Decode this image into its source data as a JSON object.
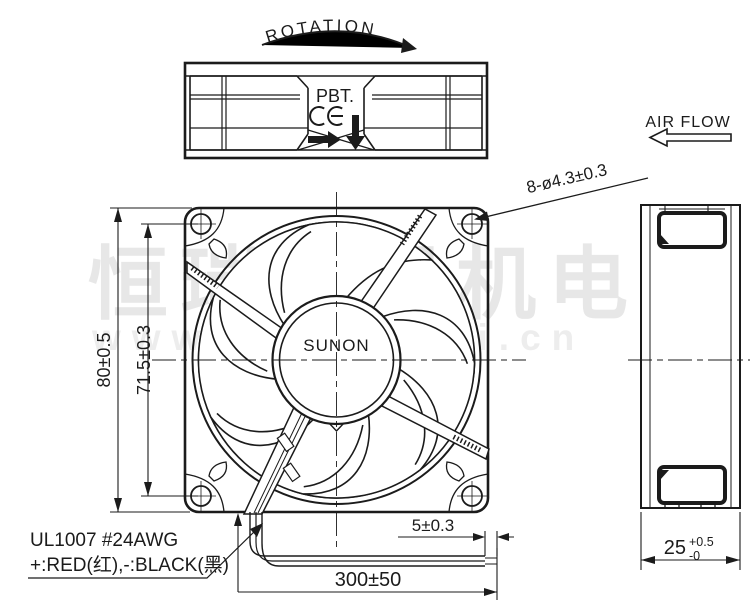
{
  "labels": {
    "rotation": "ROTATION",
    "air_flow": "AIR FLOW",
    "material": "PBT.",
    "brand": "SUNON"
  },
  "dimensions": {
    "mounting_holes": "8-ø4.3±0.3",
    "frame_width": "80±0.5",
    "hole_pitch": "71.5±0.3",
    "wire_strip": "5±0.3",
    "wire_length": "300±50",
    "frame_depth": "25",
    "frame_depth_tol_plus": "+0.5",
    "frame_depth_tol_minus": "-0"
  },
  "wire_spec": {
    "line1": "UL1007  #24AWG",
    "line2": "+:RED(红),-:BLACK(黑)"
  },
  "watermark": {
    "text_cn": "恒瑞宏晟机电",
    "url": "www.bjhengrui.cn"
  },
  "icons": {
    "rotation_arrow": "clockwise-curved-arrow",
    "ce_mark": "CE",
    "rotation_direction_arrow": "right-filled-arrow",
    "airflow_direction_arrow": "down-filled-arrow",
    "air_flow_arrow": "left-hollow-arrow"
  },
  "colors": {
    "line": "#1b1b1b",
    "watermark": "#e7e7e7",
    "background": "#ffffff"
  }
}
